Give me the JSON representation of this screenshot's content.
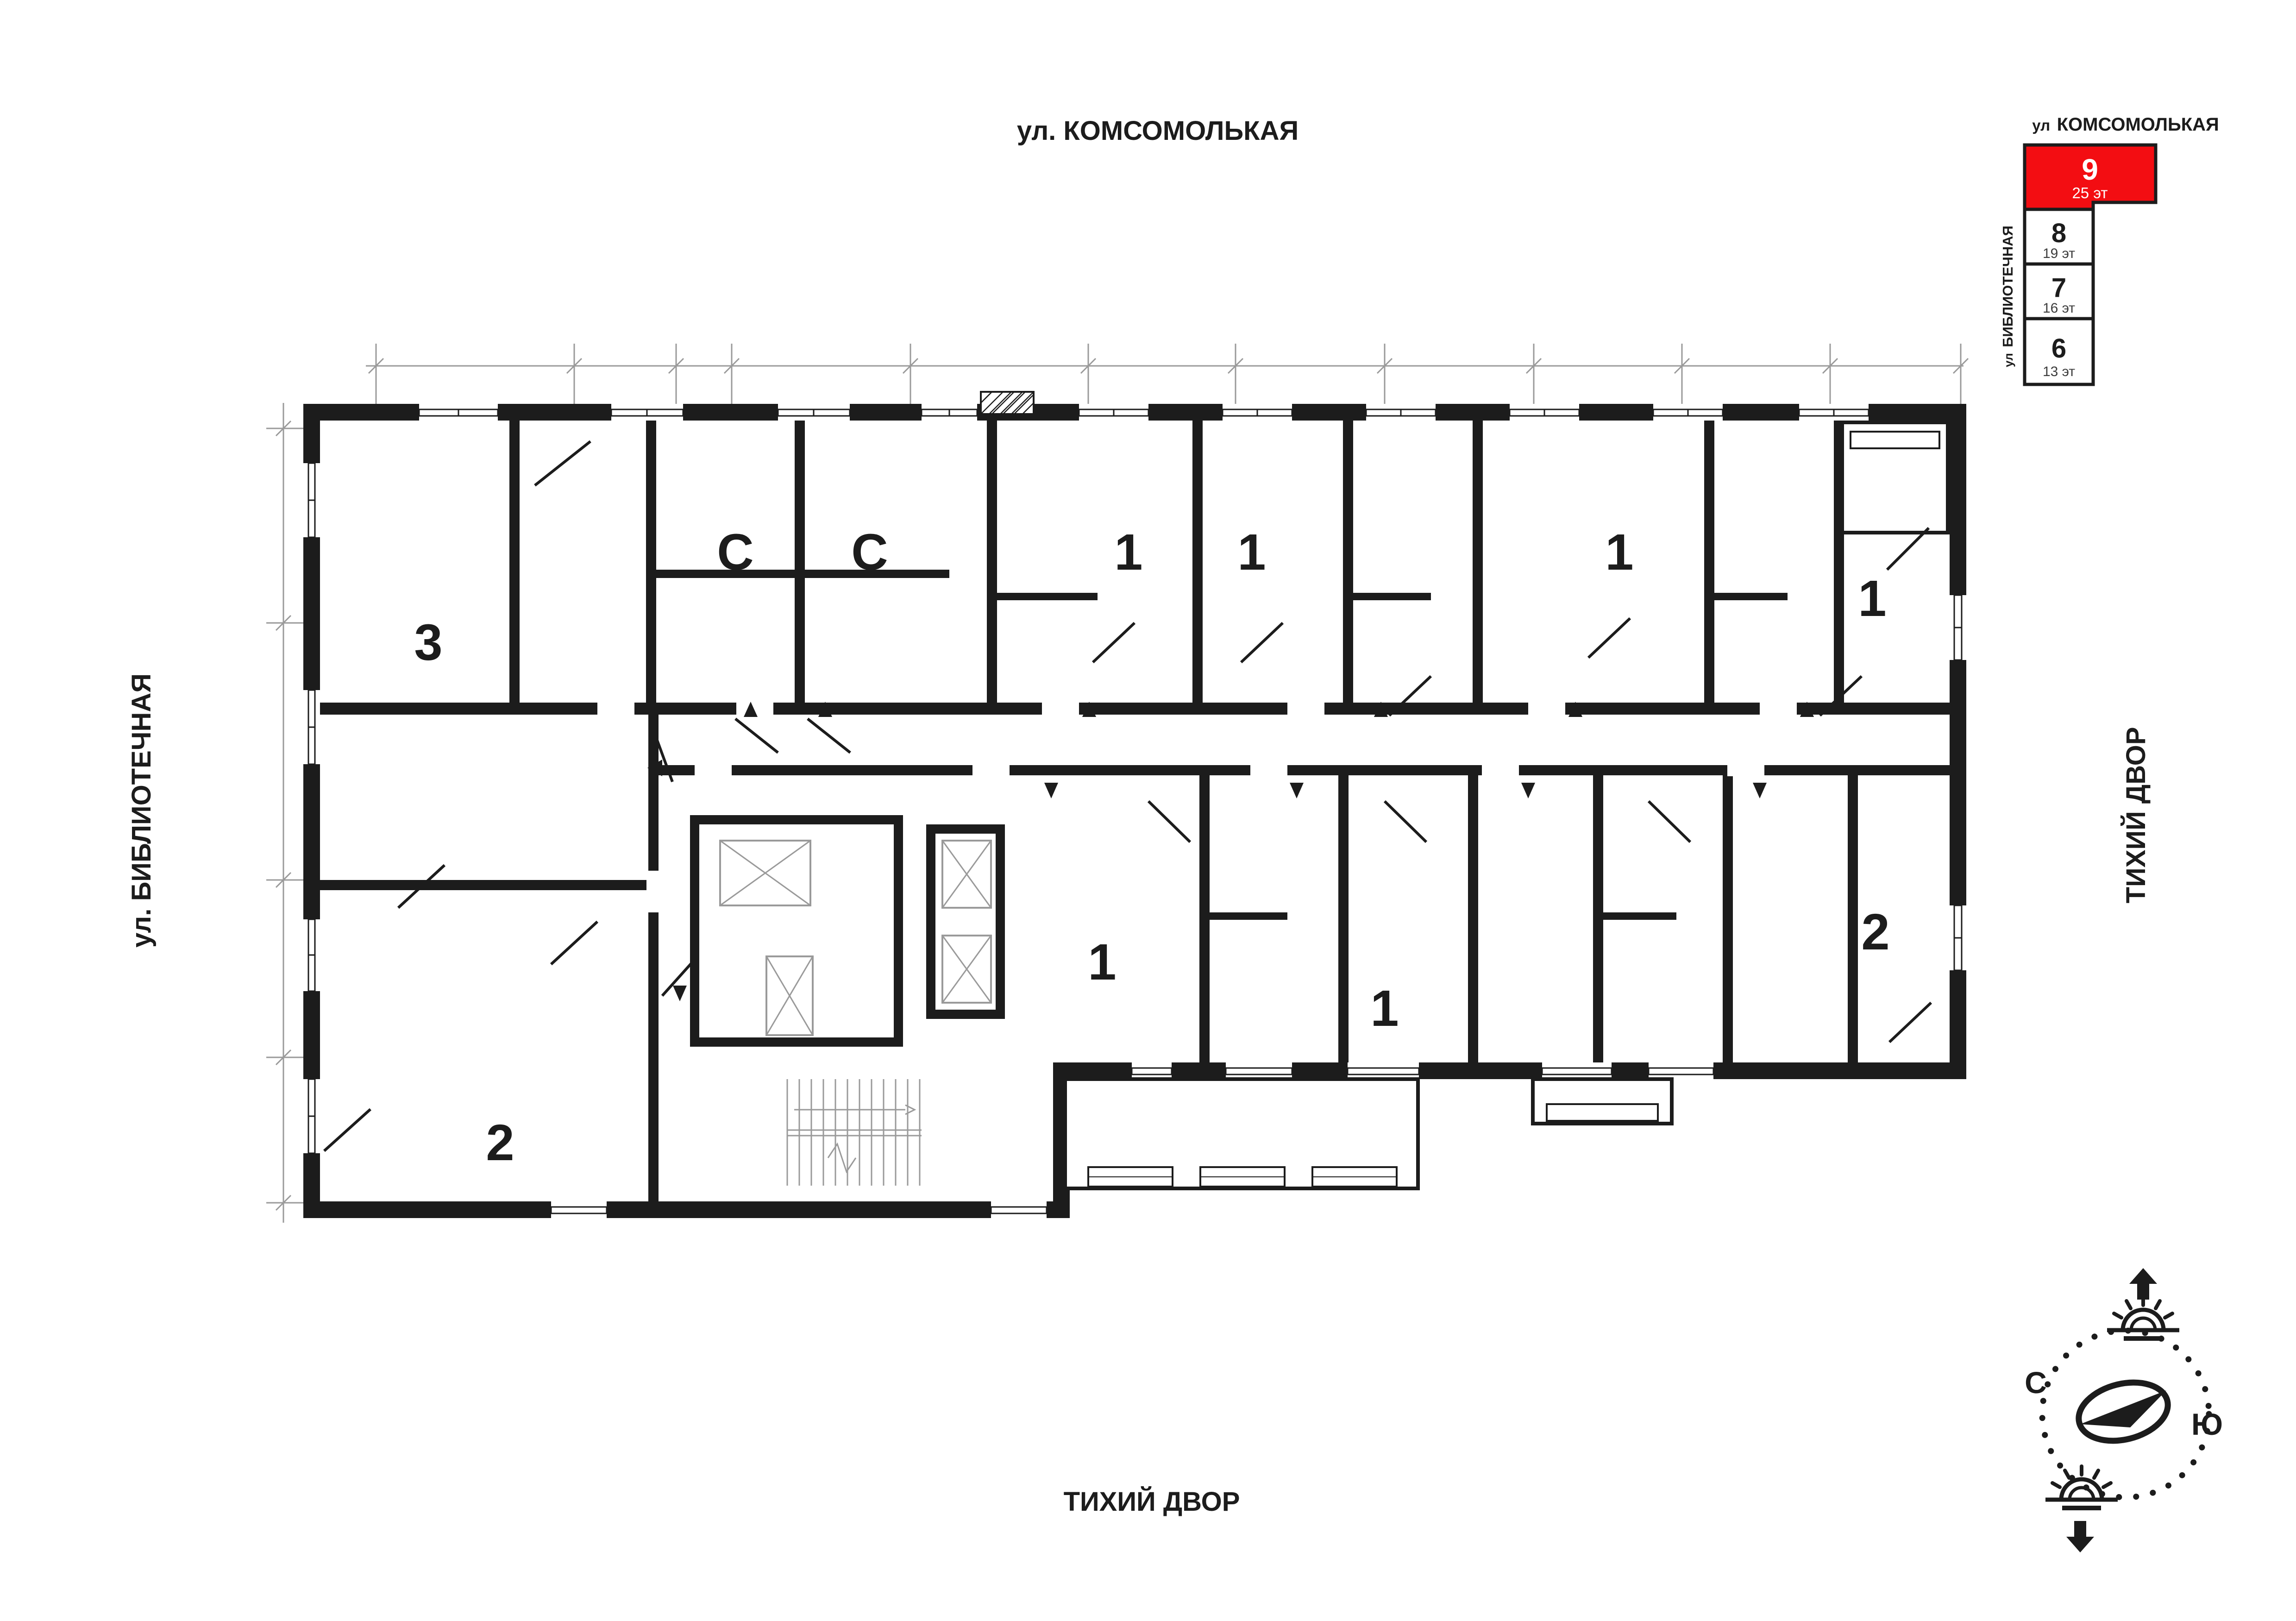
{
  "streets": {
    "top": "ул. КОМСОМОЛЬКАЯ",
    "left": "ул. БИБЛИОТЕЧНАЯ",
    "right": "ТИХИЙ ДВОР",
    "bottom": "ТИХИЙ ДВОР"
  },
  "minimap": {
    "street_top_prefix": "ул",
    "street_top_name": "КОМСОМОЛЬКАЯ",
    "street_left_prefix": "ул",
    "street_left_name": "БИБЛИОТЕЧНАЯ",
    "accent_color": "#f30d12",
    "blocks": [
      {
        "number": "9",
        "floors": "25 эт",
        "selected": true
      },
      {
        "number": "8",
        "floors": "19 эт",
        "selected": false
      },
      {
        "number": "7",
        "floors": "16 эт",
        "selected": false
      },
      {
        "number": "6",
        "floors": "13 эт",
        "selected": false
      }
    ]
  },
  "plan": {
    "apartments": [
      {
        "label": "3"
      },
      {
        "label": "С"
      },
      {
        "label": "С"
      },
      {
        "label": "1"
      },
      {
        "label": "1"
      },
      {
        "label": "1"
      },
      {
        "label": "1"
      },
      {
        "label": "2"
      },
      {
        "label": "1"
      },
      {
        "label": "1"
      },
      {
        "label": "2"
      }
    ]
  },
  "compass": {
    "north": "С",
    "south": "Ю"
  }
}
